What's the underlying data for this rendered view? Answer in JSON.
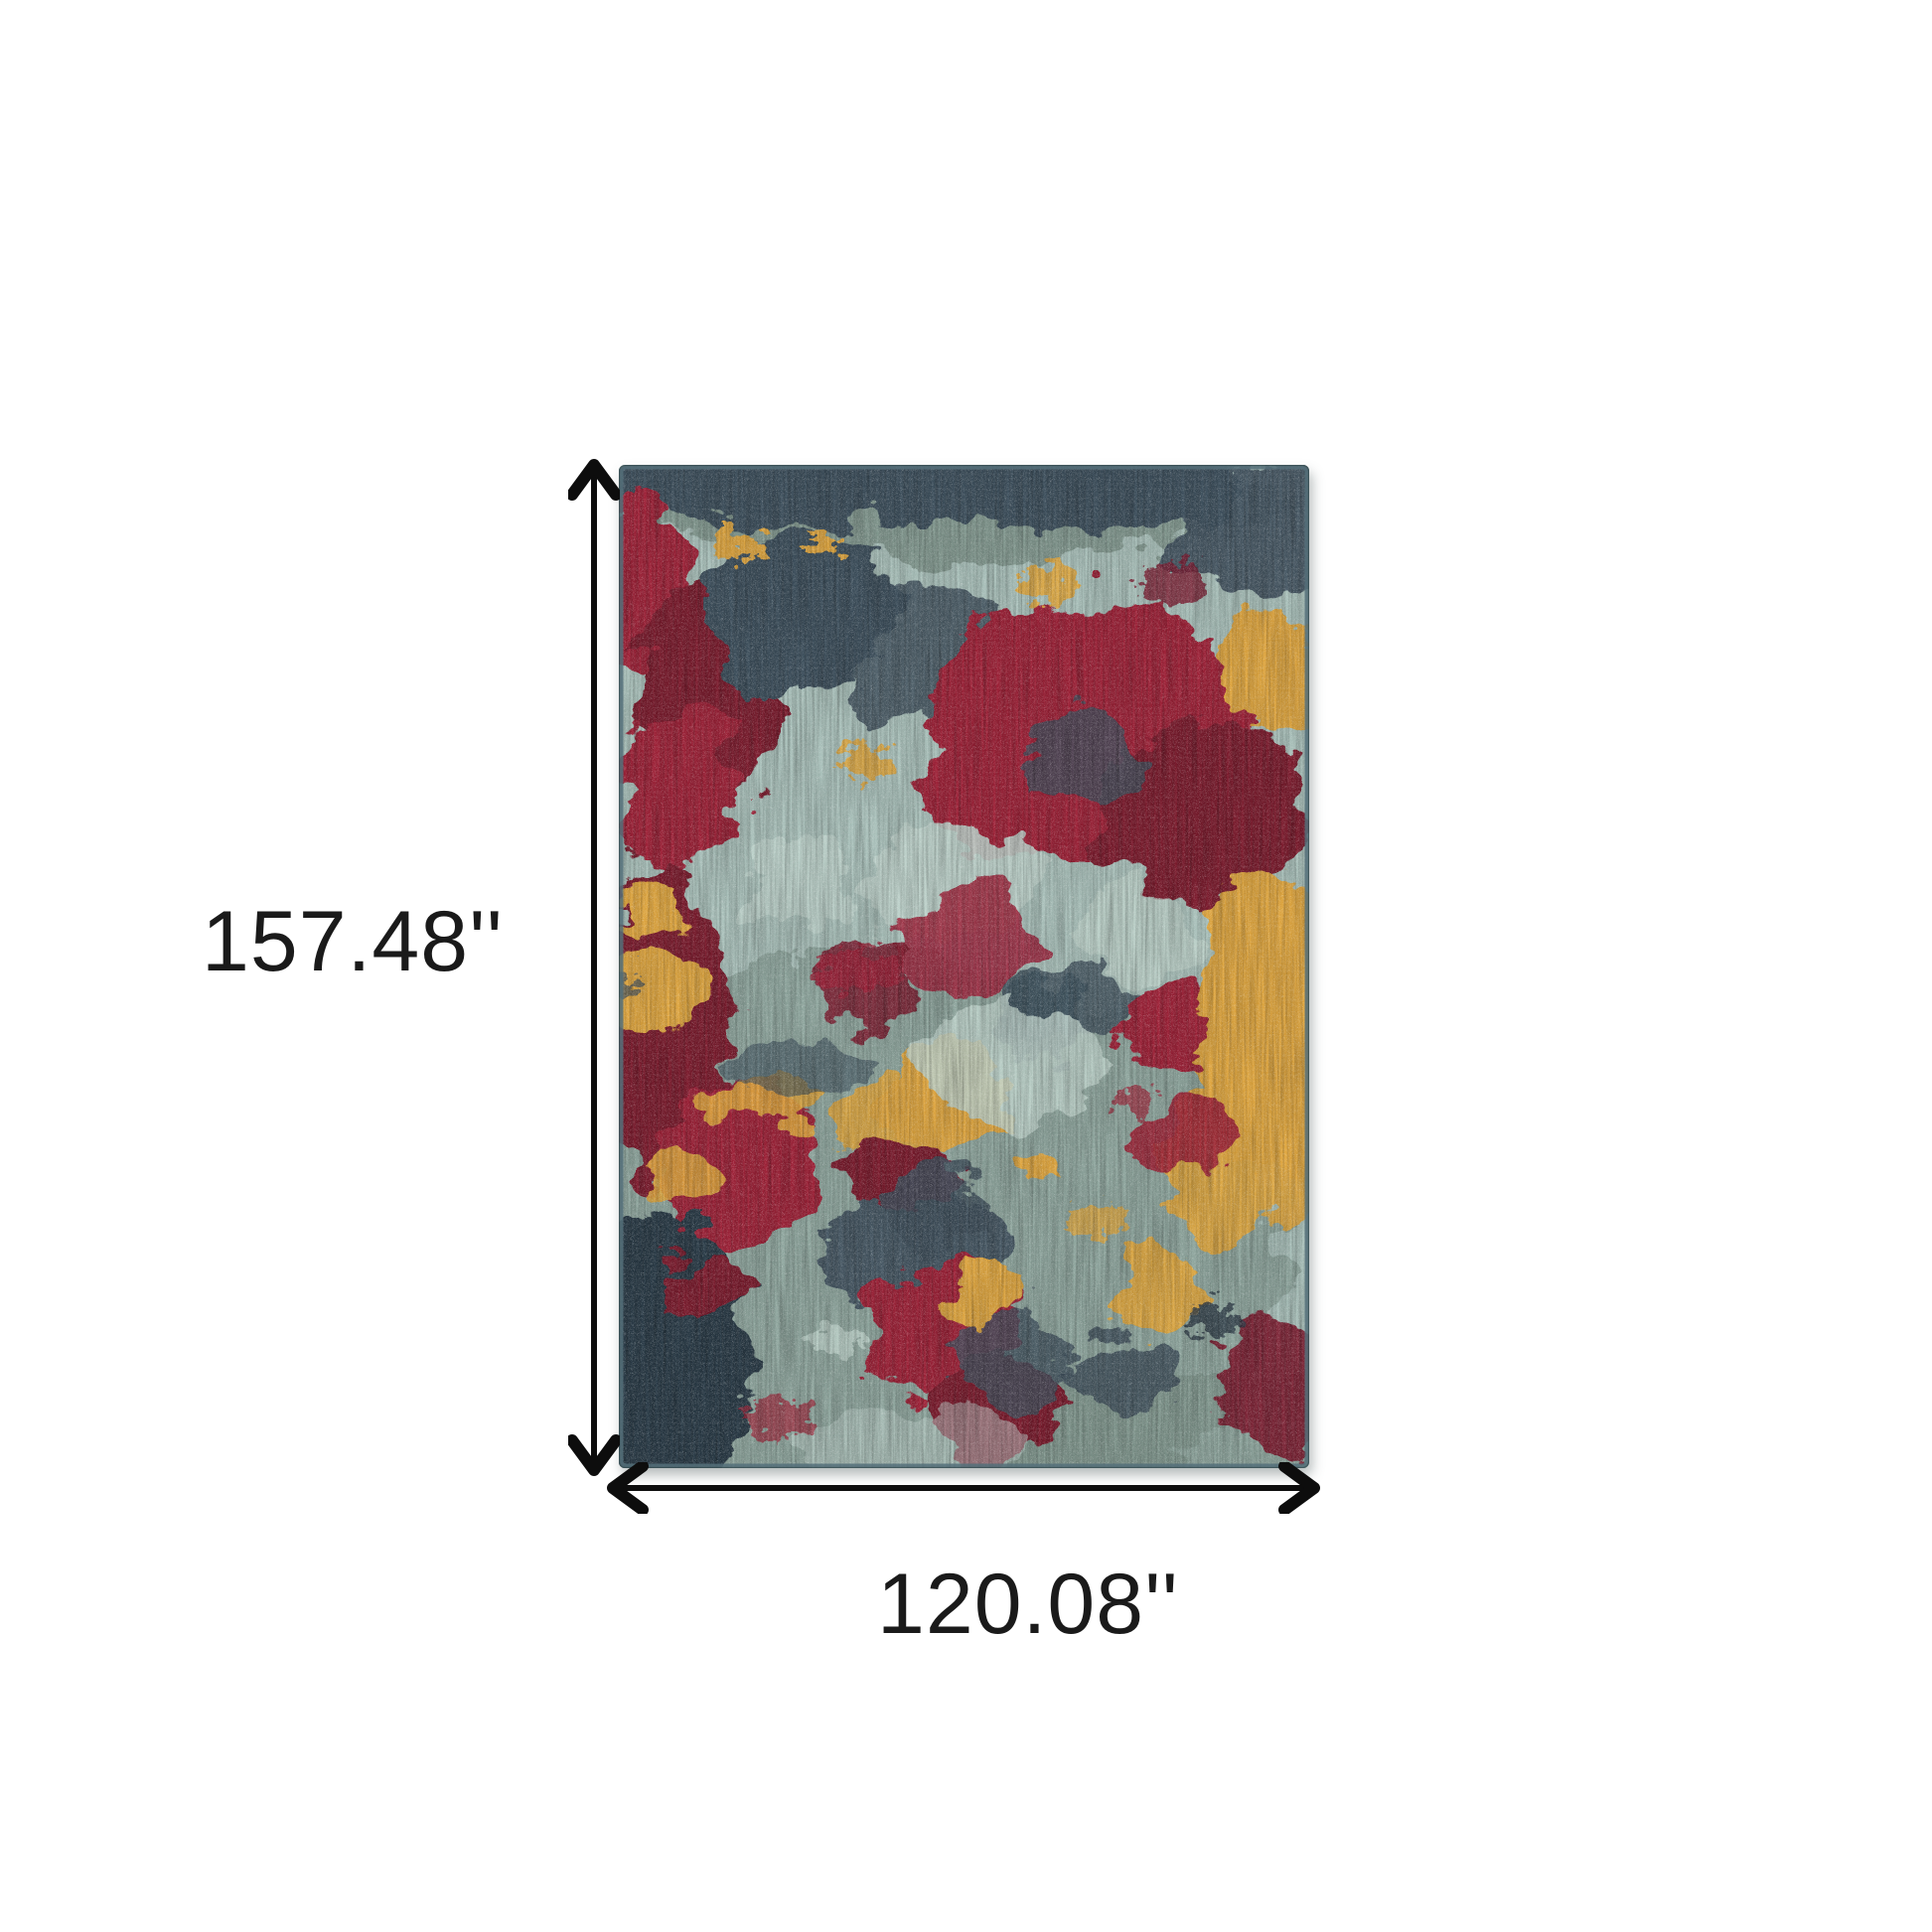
{
  "scene": {
    "type": "product-dimension-diagram",
    "background_color": "#ffffff"
  },
  "product": {
    "kind": "abstract-area-rug",
    "palette": {
      "base": "#a9c0ba",
      "pale": "#bed2cb",
      "teal": "#74897f",
      "slate": "#3e4f5c",
      "slate_dark": "#2c3a46",
      "red": "#9e2138",
      "red_dark": "#7c1b2e",
      "gold": "#dfa63f",
      "edge": "#55707a"
    }
  },
  "annotations": {
    "arrow_color": "#0d0d0d",
    "label_color": "#1a1a1a",
    "height": {
      "label": "157.48''"
    },
    "width": {
      "label": "120.08''"
    }
  }
}
